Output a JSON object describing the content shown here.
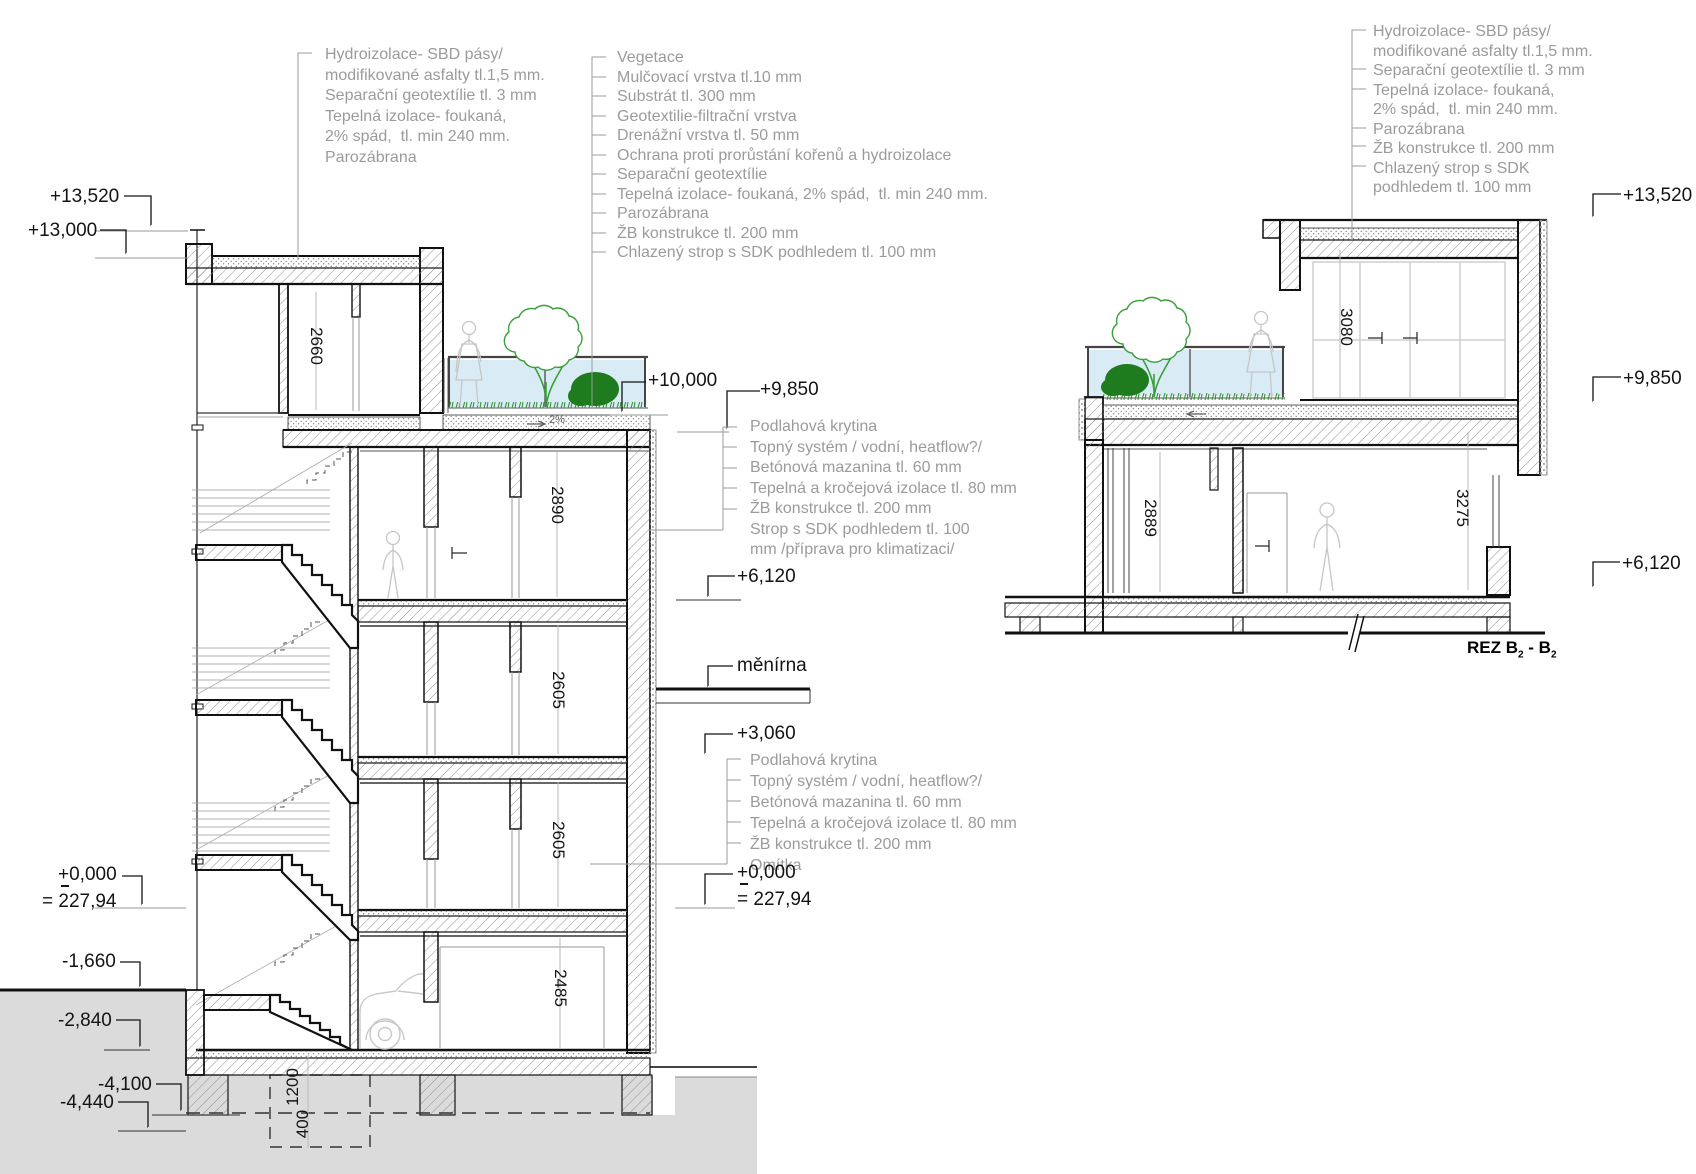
{
  "annotation_blocks": {
    "roof_left": [
      "Hydroizolace- SBD pásy/",
      "modifikované asfalty tl.1,5 mm.",
      "Separační geotextílie tl. 3 mm",
      "Tepelná izolace- foukaná,",
      "2% spád,  tl. min 240 mm.",
      "Parozábrana"
    ],
    "green_roof": [
      "Vegetace",
      "Mulčovací vrstva tl.10 mm",
      "Substrát tl. 300 mm",
      "Geotextilie-filtrační vrstva",
      "Drenážní vrstva tl. 50 mm",
      "Ochrana proti prorůstání kořenů a hydroizolace",
      "Separační geotextílie",
      "Tepelná izolace- foukaná, 2% spád,  tl. min 240 mm.",
      "Parozábrana",
      "ŽB konstrukce tl. 200 mm",
      "Chlazený strop s SDK podhledem tl. 100 mm"
    ],
    "roof_right": [
      "Hydroizolace- SBD pásy/",
      "modifikované asfalty tl.1,5 mm.",
      "Separační geotextílie tl. 3 mm",
      "Tepelná izolace- foukaná,",
      "2% spád,  tl. min 240 mm.",
      "Parozábrana",
      "ŽB konstrukce tl. 200 mm",
      "Chlazený strop s SDK",
      "podhledem tl. 100 mm"
    ],
    "floor_upper": [
      "Podlahová krytina",
      "Topný systém / vodní, heatflow?/",
      "Betónová mazanina tl. 60 mm",
      "Tepelná a kročejová izolace tl. 80 mm",
      "ŽB konstrukce tl. 200 mm",
      "Strop s SDK podhledem tl. 100",
      "mm /příprava pro klimatizaci/"
    ],
    "floor_lower": [
      "Podlahová krytina",
      "Topný systém / vodní, heatflow?/",
      "Betónová mazanina tl. 60 mm",
      "Tepelná a kročejová izolace tl. 80 mm",
      "ŽB konstrukce tl. 200 mm",
      "Omítka"
    ]
  },
  "levels_left": [
    "+13,520",
    "+13,000",
    "+0,000",
    "= 227,94",
    "-1,660",
    "-2,840",
    "-4,100",
    "-4,440"
  ],
  "levels_mid": [
    "+10,000",
    "+9,850",
    "+6,120",
    "+3,060",
    "+0,000",
    "= 227,94"
  ],
  "levels_right": [
    "+13,520",
    "+9,850",
    "+6,120"
  ],
  "room_label": "měnírna",
  "slope_label": "2%",
  "section_title": {
    "part1": "REZ B",
    "sub1": "2",
    "part2": " - B",
    "sub2": "2"
  },
  "dims_left_rooms": [
    "2660",
    "2890",
    "2605",
    "2605",
    "2485"
  ],
  "dims_right_rooms": [
    "3080",
    "2889",
    "3275"
  ],
  "dims_foundation": [
    "1200",
    "400"
  ],
  "colors": {
    "line": "#161616",
    "annotation_text": "#9b9b9b",
    "ground_fill": "#dbdbdb",
    "glass_fill": "#d9ecf5",
    "vegetation_green": "#3a9e3a",
    "bush_green": "#1e7c1e",
    "figure_gray": "#c6c6c6",
    "hatch_gray": "#8f8f8f"
  }
}
